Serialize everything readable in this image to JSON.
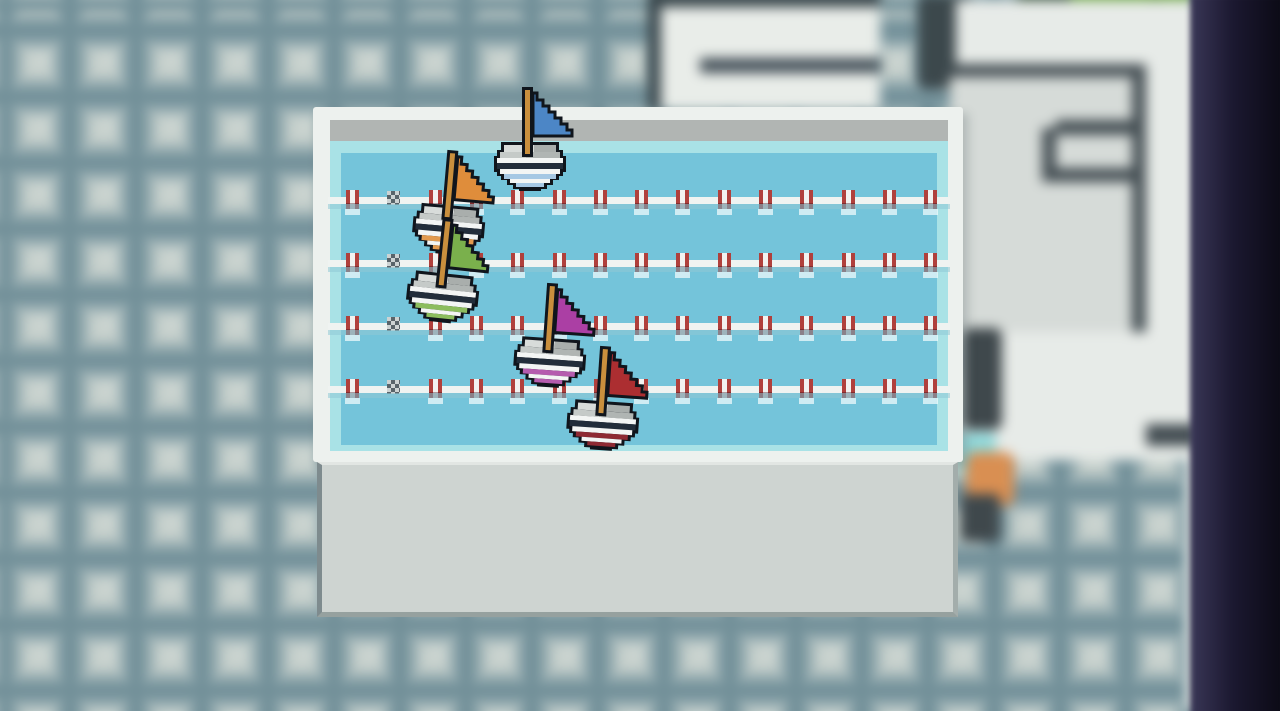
{
  "scene": {
    "description": "Pixel-art sailboat race minigame in a swimming pool, seen in front of a blurred tiled room",
    "background": {
      "floor": "blurred gray-teal wall tiles",
      "right_structure": "blurred white pixel furniture with dark outlines",
      "npc": "blurred bystander figure beside pool",
      "plant": "green foliage at top right",
      "dark_strip_color": "#14121f"
    },
    "pool": {
      "frame_color": "#edf1ee",
      "edge_bar_color": "#b1b5b3",
      "shallow_border_color": "#a9e2e6",
      "water_color": "#74c4da",
      "platform_color": "#ced4d1",
      "lane_count": 5,
      "mast_color": "#c98f3d",
      "hull_navy_band": "#222d3a",
      "outline_color": "#10151c",
      "lane_ropes": {
        "count": 4,
        "y_positions": [
          197,
          260,
          323,
          386
        ],
        "x_start": 328,
        "x_end": 950,
        "float_start_x": 346,
        "float_spacing": 41.3,
        "float_count": 15,
        "checker_index": 1,
        "float_red_color": "#b0403c",
        "float_white_color": "#f2f2f0",
        "checker_dark_color": "#59646a",
        "checker_light_color": "#cdd3d3"
      },
      "boats": [
        {
          "color_name": "blue",
          "flag_color": "#4c86c6",
          "stripe_color": "#a6c8e4",
          "lane": 1,
          "x": 494,
          "y": 86,
          "tilt_deg": 0
        },
        {
          "color_name": "orange",
          "flag_color": "#df8d3b",
          "stripe_color": "#e29a4e",
          "lane": 2,
          "x": 413,
          "y": 149,
          "tilt_deg": 5
        },
        {
          "color_name": "green",
          "flag_color": "#7ab04c",
          "stripe_color": "#8cbd5e",
          "lane": 3,
          "x": 407,
          "y": 217,
          "tilt_deg": 6
        },
        {
          "color_name": "magenta",
          "flag_color": "#ab3fa4",
          "stripe_color": "#b55cae",
          "lane": 4,
          "x": 514,
          "y": 282,
          "tilt_deg": 4
        },
        {
          "color_name": "red",
          "flag_color": "#ac2e31",
          "stripe_color": "#8e2a33",
          "lane": 5,
          "x": 567,
          "y": 345,
          "tilt_deg": 4
        }
      ]
    }
  }
}
